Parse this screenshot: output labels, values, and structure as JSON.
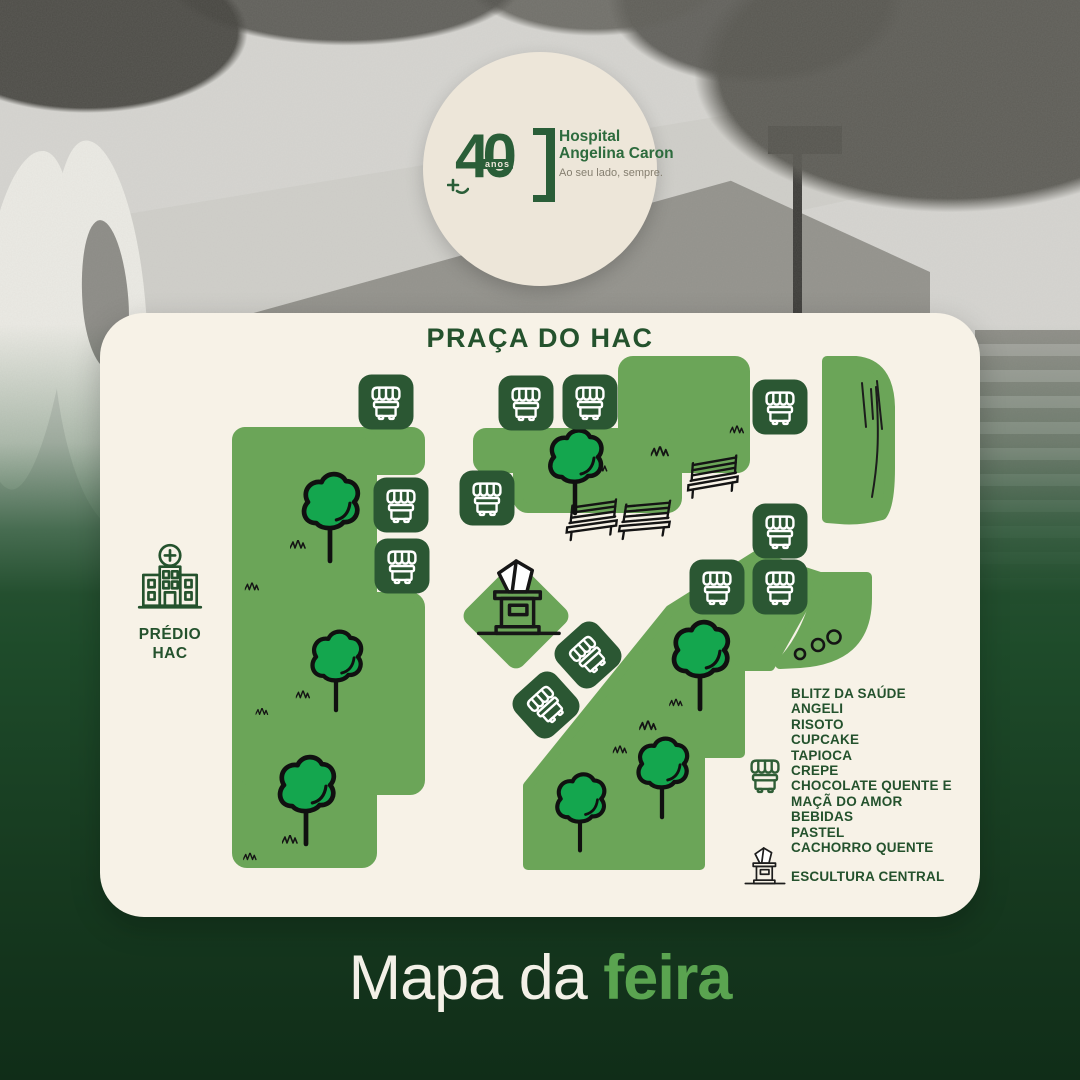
{
  "badge": {
    "years": "40",
    "years_unit": "anos",
    "hospital_line1": "Hospital",
    "hospital_line2": "Angelina Caron",
    "tagline": "Ao seu lado, sempre."
  },
  "card": {
    "title": "PRAÇA DO HAC",
    "building_line1": "PRÉDIO",
    "building_line2": "HAC"
  },
  "legend": {
    "items": [
      "BLITZ DA SAÚDE",
      "ANGELI",
      "RISOTO",
      "CUPCAKE",
      "TAPIOCA",
      "CREPE",
      "CHOCOLATE QUENTE E MAÇÃ DO AMOR",
      "BEBIDAS",
      "PASTEL",
      "CACHORRO QUENTE"
    ],
    "stall_icon": "food-stall-icon",
    "sculpture_icon": "sculpture-icon",
    "sculpture_label": "ESCULTURA CENTRAL"
  },
  "footer": {
    "prefix": "Mapa da ",
    "highlight": "feira"
  },
  "colors": {
    "card_bg": "#F7F2E7",
    "badge_bg": "#EDE6D9",
    "tile_green": "#2B5733",
    "area_green": "#6BA558",
    "tree_green": "#14A64E",
    "ink_green": "#24522D",
    "feira_green": "#5AA450"
  },
  "map": {
    "stalls": [
      {
        "x": 386,
        "y": 402,
        "r": 0
      },
      {
        "x": 401,
        "y": 505,
        "r": 0
      },
      {
        "x": 402,
        "y": 566,
        "r": 0
      },
      {
        "x": 526,
        "y": 403,
        "r": 0
      },
      {
        "x": 590,
        "y": 402,
        "r": 0
      },
      {
        "x": 487,
        "y": 498,
        "r": 0
      },
      {
        "x": 780,
        "y": 407,
        "r": 0
      },
      {
        "x": 780,
        "y": 531,
        "r": 0
      },
      {
        "x": 717,
        "y": 587,
        "r": 0
      },
      {
        "x": 780,
        "y": 587,
        "r": 0
      },
      {
        "x": 588,
        "y": 655,
        "r": -42
      },
      {
        "x": 546,
        "y": 705,
        "r": -42
      }
    ],
    "trees": [
      {
        "x": 330,
        "y": 500,
        "s": 1.05
      },
      {
        "x": 336,
        "y": 655,
        "s": 0.95
      },
      {
        "x": 306,
        "y": 783,
        "s": 1.05
      },
      {
        "x": 575,
        "y": 455,
        "s": 1.0
      },
      {
        "x": 700,
        "y": 648,
        "s": 1.05
      },
      {
        "x": 662,
        "y": 762,
        "s": 0.95
      },
      {
        "x": 580,
        "y": 797,
        "s": 0.92
      }
    ],
    "benches": [
      {
        "x": 712,
        "y": 478,
        "r": -10
      },
      {
        "x": 591,
        "y": 521,
        "r": -8
      },
      {
        "x": 644,
        "y": 521,
        "r": -5
      }
    ],
    "grass": [
      {
        "x": 298,
        "y": 545,
        "s": 1.0
      },
      {
        "x": 252,
        "y": 587,
        "s": 0.9
      },
      {
        "x": 303,
        "y": 695,
        "s": 0.9
      },
      {
        "x": 262,
        "y": 712,
        "s": 0.8
      },
      {
        "x": 290,
        "y": 840,
        "s": 1.0
      },
      {
        "x": 250,
        "y": 857,
        "s": 0.85
      },
      {
        "x": 737,
        "y": 430,
        "s": 0.9
      },
      {
        "x": 660,
        "y": 452,
        "s": 1.15
      },
      {
        "x": 600,
        "y": 468,
        "s": 0.95
      },
      {
        "x": 676,
        "y": 703,
        "s": 0.85
      },
      {
        "x": 648,
        "y": 726,
        "s": 1.1
      },
      {
        "x": 620,
        "y": 750,
        "s": 0.9
      }
    ],
    "dots": [
      {
        "x": 800,
        "y": 654,
        "r": 5
      },
      {
        "x": 818,
        "y": 645,
        "r": 6
      },
      {
        "x": 834,
        "y": 637,
        "r": 6.5
      }
    ],
    "sculpture": {
      "x": 476,
      "y": 557,
      "s": 1.34
    },
    "diamond": {
      "x": 516,
      "y": 616,
      "size": 80
    }
  }
}
